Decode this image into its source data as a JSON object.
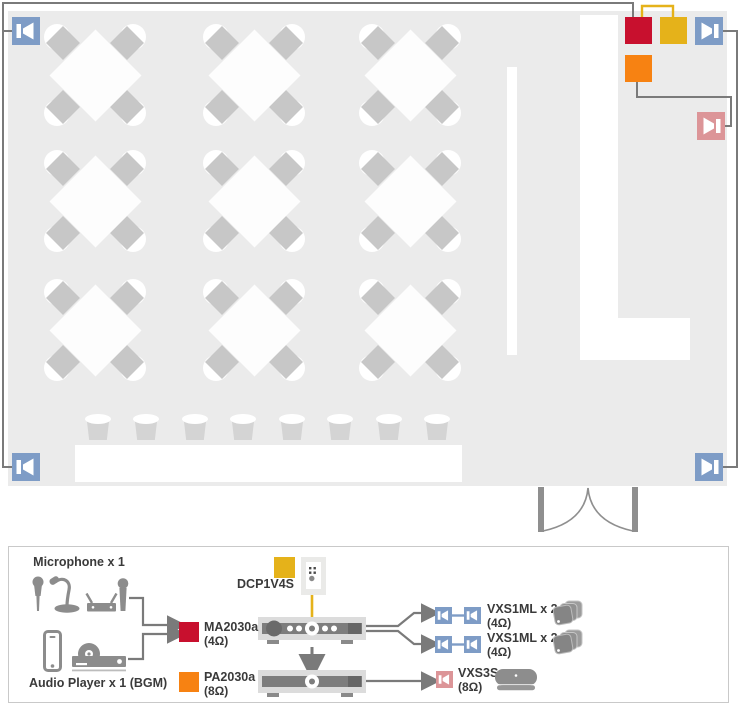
{
  "floor_plan": {
    "tables_count": 9,
    "stools_count": 8,
    "wire_color": "#7a7a7a",
    "wall_speaker_color": "#7e9cc6",
    "surface_speaker_color": "#dc9598",
    "devices": {
      "ma2030a_marker_color": "#c8102e",
      "dcp1v4s_marker_color": "#e5b21a",
      "pa2030a_marker_color": "#f78212"
    }
  },
  "diagram": {
    "inputs": {
      "microphone_label": "Microphone x 1",
      "audio_player_label": "Audio Player x 1 (BGM)"
    },
    "dcp": {
      "label": "DCP1V4S"
    },
    "ma": {
      "label": "MA2030a",
      "impedance": "(4Ω)"
    },
    "pa": {
      "label": "PA2030a",
      "impedance": "(8Ω)"
    },
    "outputs": {
      "vxs1ml_a": {
        "label": "VXS1ML x 2",
        "impedance": "(4Ω)"
      },
      "vxs1ml_b": {
        "label": "VXS1ML x 2",
        "impedance": "(4Ω)"
      },
      "vxs3s": {
        "label": "VXS3S",
        "impedance": "(8Ω)"
      }
    }
  }
}
